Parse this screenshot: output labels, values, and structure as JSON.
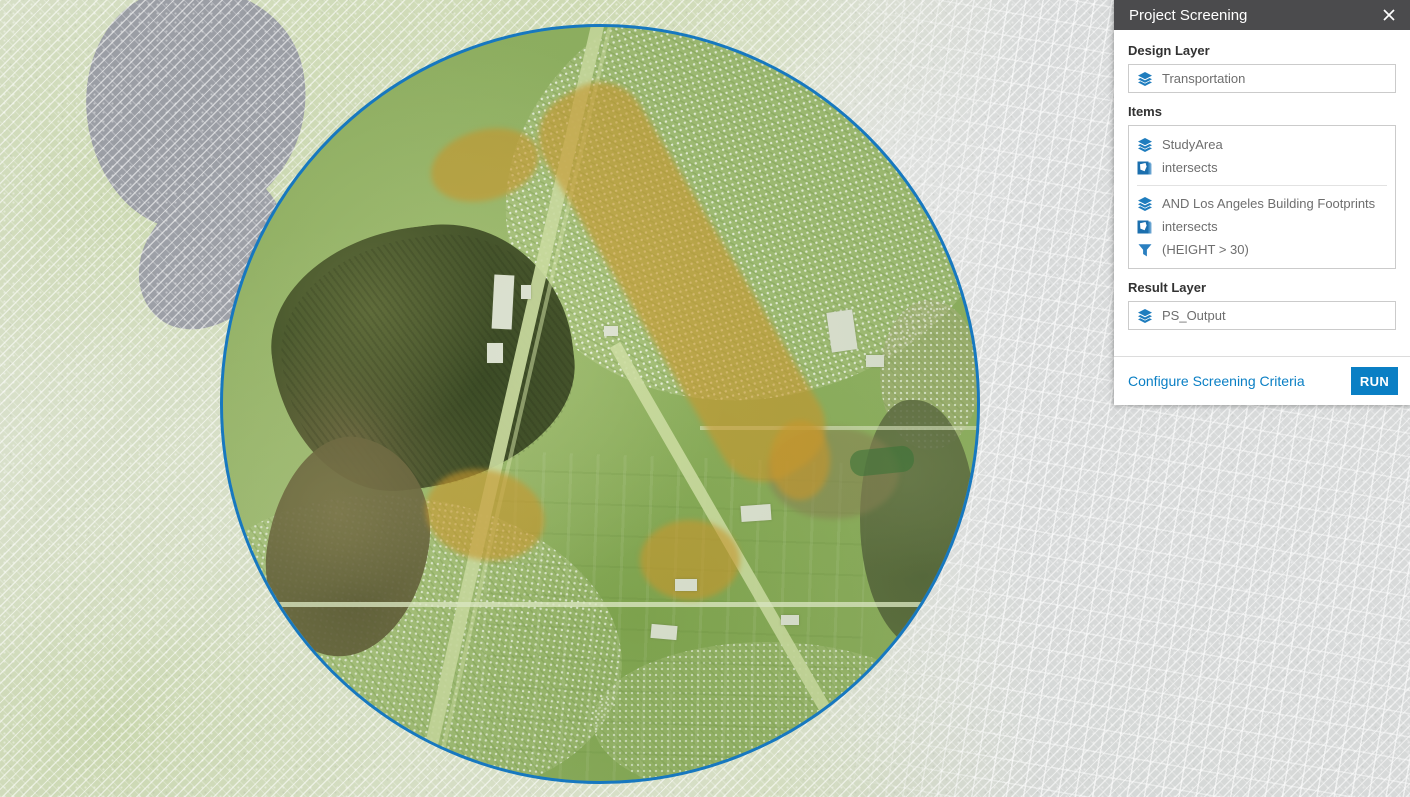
{
  "panel": {
    "title": "Project Screening",
    "design_layer_label": "Design Layer",
    "design_layer_value": "Transportation",
    "items_label": "Items",
    "item_groups": [
      {
        "rows": [
          {
            "icon": "layers-icon",
            "text": "StudyArea"
          },
          {
            "icon": "intersects-icon",
            "text": "intersects"
          }
        ]
      },
      {
        "rows": [
          {
            "icon": "layers-icon",
            "text": "AND Los Angeles Building Footprints"
          },
          {
            "icon": "intersects-icon",
            "text": "intersects"
          },
          {
            "icon": "filter-icon",
            "text": "(HEIGHT > 30)"
          }
        ]
      }
    ],
    "result_layer_label": "Result Layer",
    "result_layer_value": "PS_Output",
    "configure_link": "Configure Screening Criteria",
    "run_label": "RUN"
  },
  "map": {
    "study_area_shape": "circle",
    "overlays": [
      "screening buffer (green)",
      "impact corridor (orange)"
    ],
    "basemap_style": "faded satellite with diagonal hatch"
  },
  "colors": {
    "header_bg": "#4b4b4d",
    "accent_blue": "#0a7fc4",
    "icon_blue": "#1f7dbe",
    "circle_border": "#1778bf",
    "overlay_orange": "#d69428",
    "faded_green": "#c7d6a9",
    "faded_gray": "#d6d8d9",
    "lake_gray": "#9b9ea5"
  }
}
